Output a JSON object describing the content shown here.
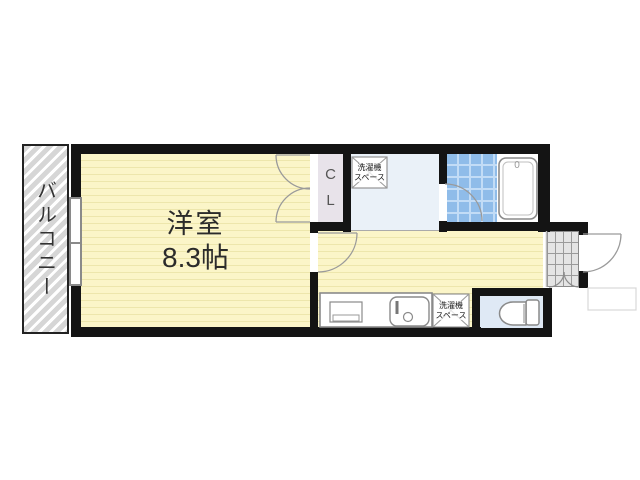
{
  "floorplan": {
    "rooms": {
      "balcony": {
        "label": "バルコニー"
      },
      "main_room": {
        "label": "洋室",
        "size": "8.3帖"
      },
      "closet": {
        "line1": "C",
        "line2": "L"
      },
      "washer_space": {
        "line1": "洗濯機",
        "line2": "スペース"
      },
      "bathtub_mark": "0"
    },
    "colors": {
      "wall": "#141414",
      "room-fill": "#FBF5C8",
      "room-stripe": "#EDE6AC",
      "balcony-fill": "#D6D6D6",
      "closet-fill": "#E8E3EA",
      "washroom-fill": "#EAF1F8",
      "bath-tile": "#8FBCE9",
      "bath-tile-line": "#C2DCF6",
      "toilet-fill": "#DFE9F5",
      "genkan-fill": "#E4E4E4",
      "fixture-stroke": "#8A8A8A",
      "arc-stroke": "#9A9A9A"
    }
  }
}
